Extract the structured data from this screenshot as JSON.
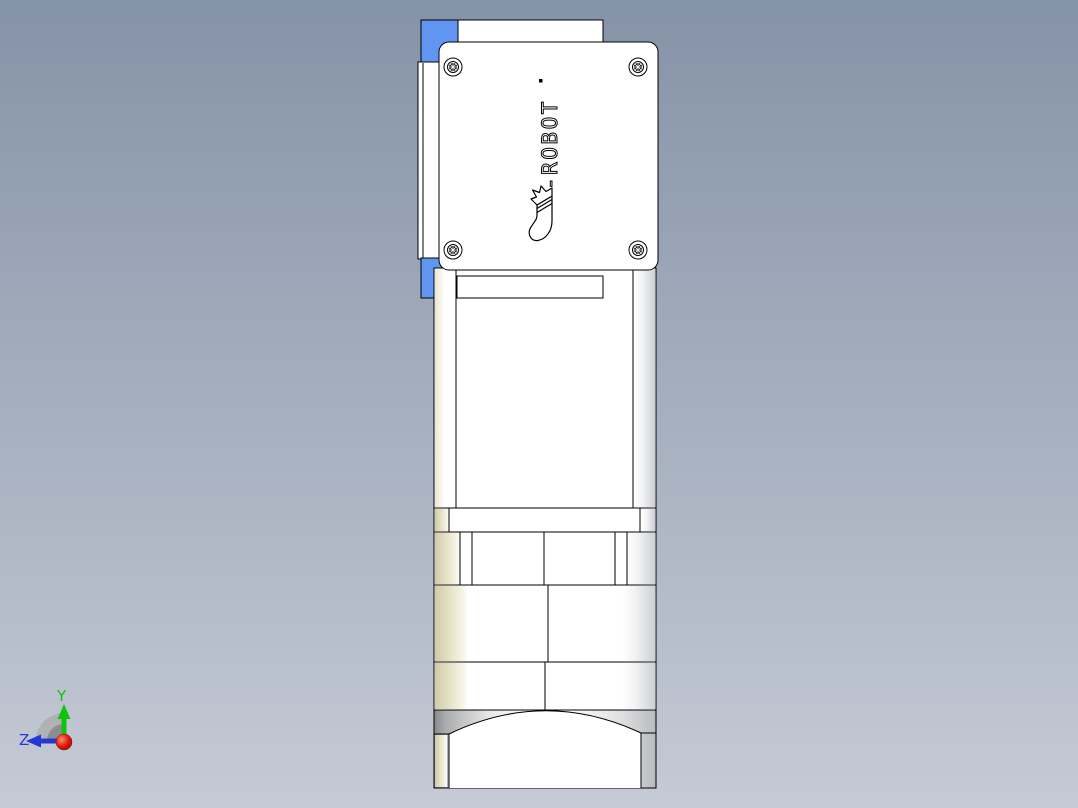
{
  "viewport": {
    "description_text": ""
  },
  "logo": {
    "text": "-ROBOT"
  },
  "triad": {
    "y_label": "Y",
    "z_label": "Z"
  },
  "colors": {
    "bg_top": "#8593a8",
    "bg_bottom": "#c5cad5",
    "bracket_blue": "#6095f2",
    "part_white": "#ffffff",
    "edge_black": "#000000",
    "cream_shade": "#d6d2b0",
    "gray_shade": "#c6c8cc",
    "axis_y_green": "#0fc40f",
    "axis_z_blue": "#2338d4",
    "origin_red": "#e01808",
    "logo_fill": "#ffffff"
  }
}
